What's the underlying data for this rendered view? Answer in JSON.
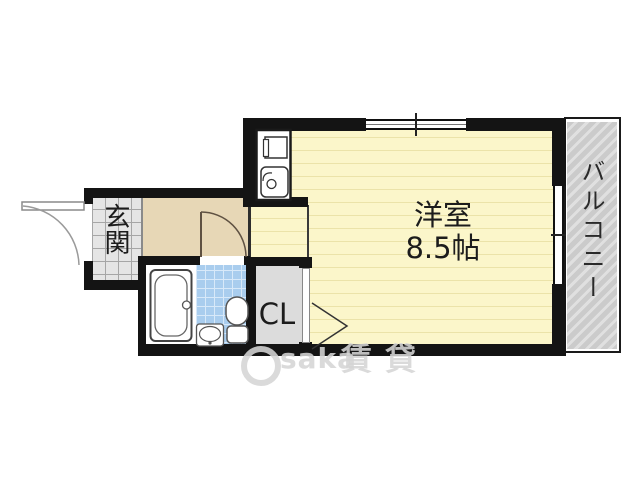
{
  "labels": {
    "entrance": "玄関",
    "room_name": "洋室",
    "room_size": "8.5帖",
    "closet": "CL",
    "balcony": "バルコニー"
  },
  "watermark": {
    "text": "Osaka賃貸",
    "latin_part": "saka",
    "kanji_part": "賃貸"
  },
  "rooms": [
    {
      "name": "洋室",
      "size": "8.5帖",
      "type": "western-room"
    },
    {
      "name": "玄関",
      "type": "entrance"
    },
    {
      "name": "CL",
      "type": "closet"
    },
    {
      "name": "バルコニー",
      "type": "balcony"
    }
  ],
  "fixtures": [
    "kitchen-sink-unit",
    "bathtub",
    "toilet",
    "washbasin",
    "entry-door",
    "hall-door",
    "closet-door",
    "window-top",
    "window-right"
  ],
  "colors": {
    "room-fill": "#FBF6CA",
    "room-stripe": "#EBE3A9",
    "hall-fill": "#E7D7B6",
    "genkan-fill": "#E5E5E5",
    "genkan-grid": "#A6A6A6",
    "tile-blue": "#A9CDEE",
    "tile-grid": "#D8E9F9",
    "closet-fill": "#DCDCDC",
    "balcony-fill": "#CBCBCB",
    "balcony-stripe": "#E0E0E0",
    "wall": "#141414",
    "text": "#1C1C1C",
    "watermark": "#D5D5D5"
  }
}
